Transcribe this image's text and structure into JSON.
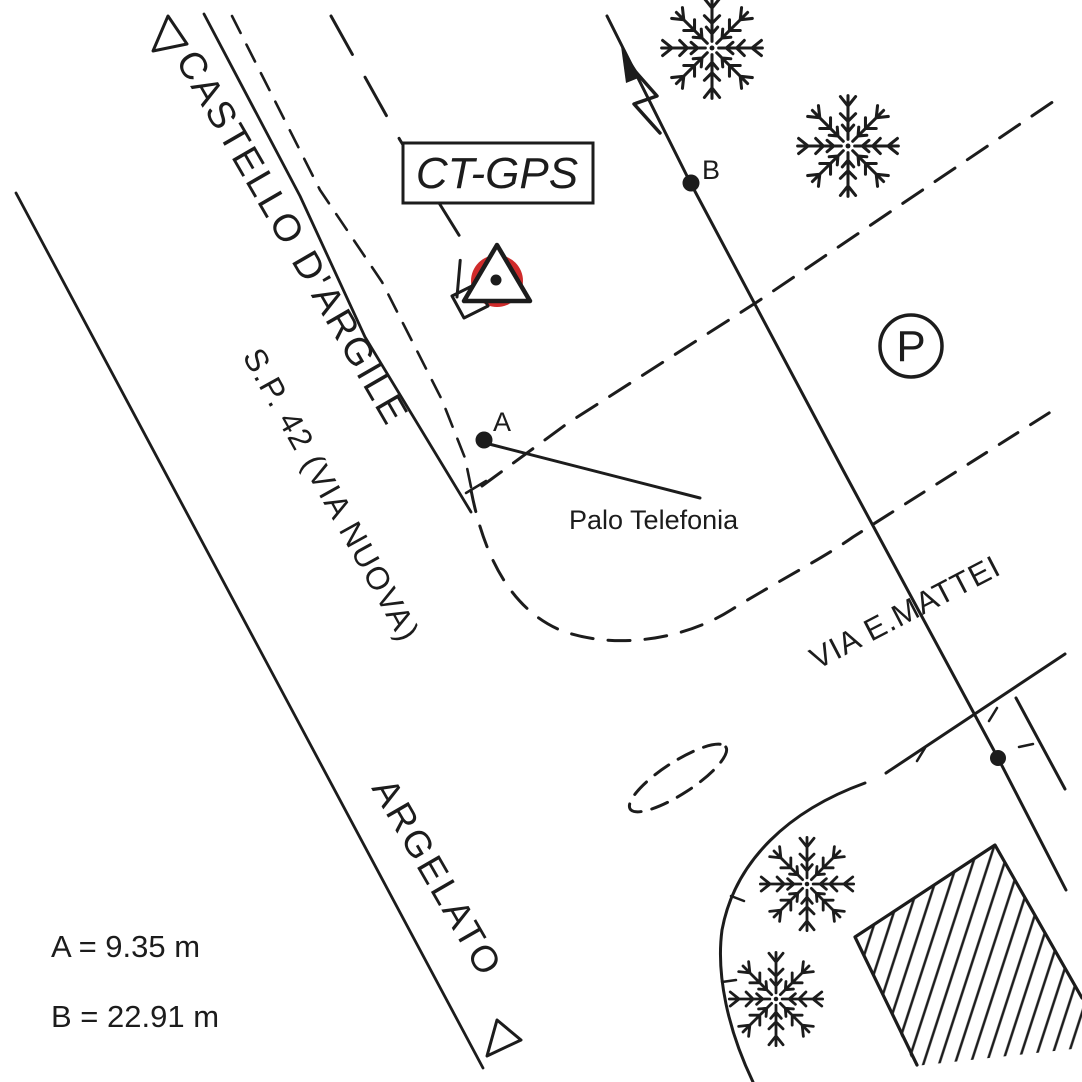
{
  "map": {
    "station": {
      "label": "CT-GPS"
    },
    "points": {
      "a": {
        "label": "A"
      },
      "b": {
        "label": "B"
      }
    },
    "notes": {
      "palo_telefonia": "Palo Telefonia"
    },
    "roads": {
      "destination_north": "CASTELLO D'ARGILE",
      "main": "S.P. 42 (VIA NUOVA)",
      "destination_south": "ARGELATO",
      "side": "VIA E.MATTEI"
    },
    "parking": {
      "label": "P"
    },
    "distances": {
      "a": {
        "text": "A = 9.35 m",
        "point": "A",
        "value": 9.35,
        "unit": "m"
      },
      "b": {
        "text": "B = 22.91 m",
        "point": "B",
        "value": 22.91,
        "unit": "m"
      }
    },
    "colors": {
      "ink": "#1c1c1c",
      "station_highlight": "#cf2b2b",
      "paper": "#ffffff"
    }
  }
}
